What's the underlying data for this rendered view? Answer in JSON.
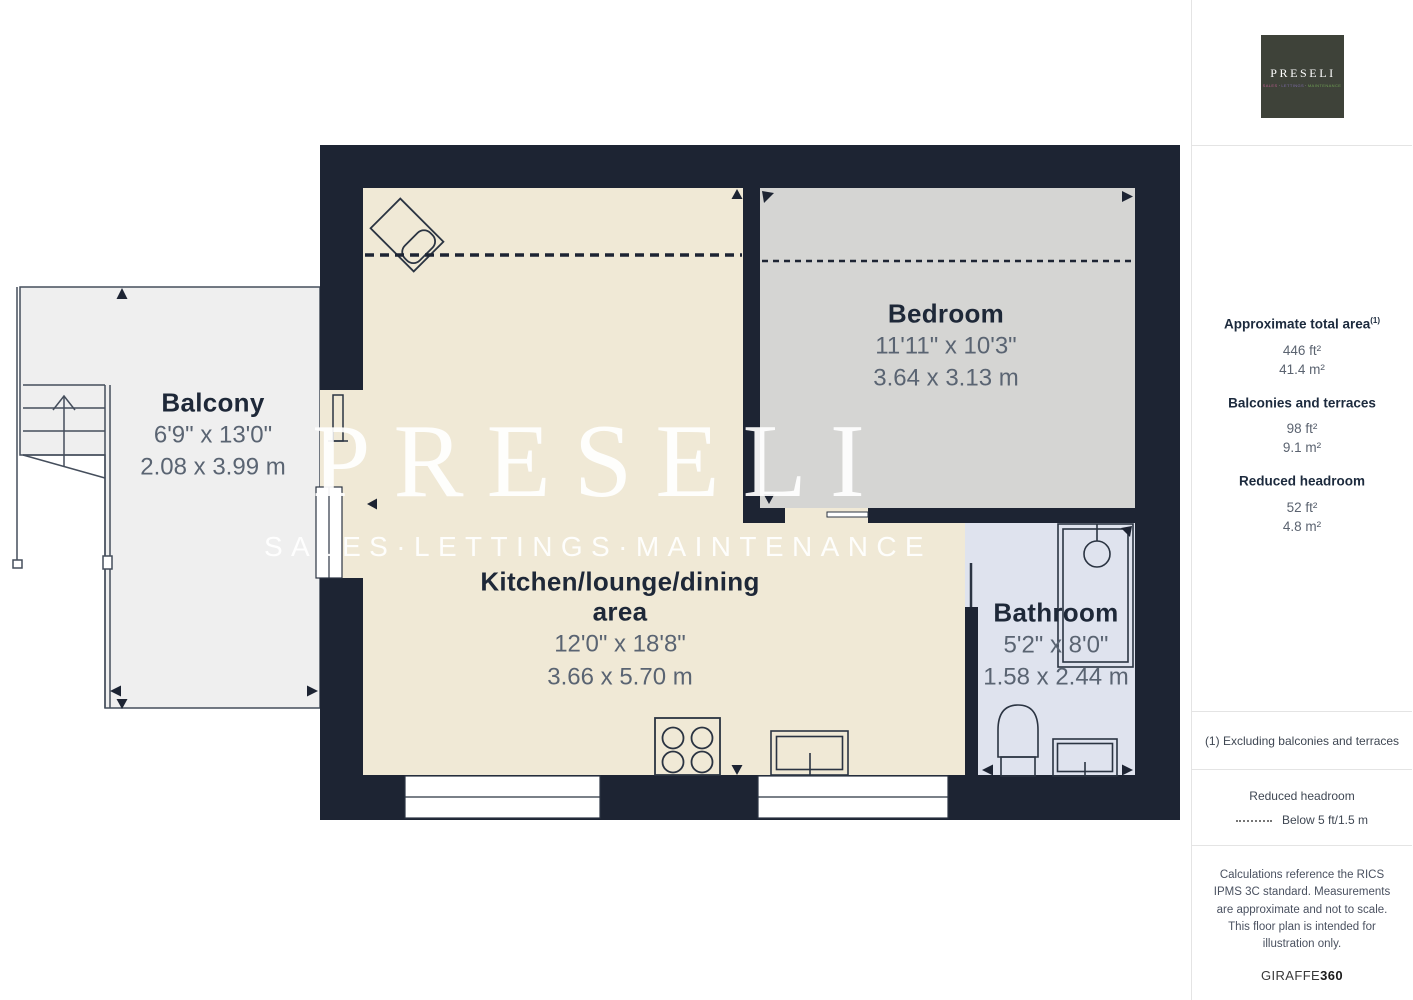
{
  "plan": {
    "watermark": {
      "title": "PRESELI",
      "subtitle": "SALES·LETTINGS·MAINTENANCE"
    },
    "rooms": [
      {
        "name": "Balcony",
        "dim_ft": "6'9\" x 13'0\"",
        "dim_m": "2.08 x 3.99 m"
      },
      {
        "name": "Bedroom",
        "dim_ft": "11'11\" x 10'3\"",
        "dim_m": "3.64 x 3.13 m"
      },
      {
        "name": "Kitchen/lounge/dining area",
        "dim_ft": "12'0\" x 18'8\"",
        "dim_m": "3.66 x 5.70 m"
      },
      {
        "name": "Bathroom",
        "dim_ft": "5'2\" x 8'0\"",
        "dim_m": "1.58 x 2.44 m"
      }
    ],
    "colors": {
      "wall": "#1d2433",
      "kitchen_fill": "#f0e9d6",
      "bedroom_fill": "#d5d5d3",
      "bathroom_fill": "#dfe3ee",
      "balcony_fill": "#efefef",
      "room_name_text": "#1e2838",
      "dimension_text": "#5a6472"
    }
  },
  "logo": {
    "name": "PRESELI",
    "separator": "·",
    "tagline": [
      "SALES",
      "LETTINGS",
      "MAINTENANCE"
    ],
    "colors": {
      "background": "#3e4239",
      "sales": "#b85c8d",
      "lettings": "#7f6cab",
      "maintenance": "#6f9e53"
    }
  },
  "sidebar": {
    "stats": [
      {
        "label": "Approximate total area",
        "sup": "(1)",
        "values": [
          "446 ft²",
          "41.4 m²"
        ]
      },
      {
        "label": "Balconies and terraces",
        "sup": "",
        "values": [
          "98 ft²",
          "9.1 m²"
        ]
      },
      {
        "label": "Reduced headroom",
        "sup": "",
        "values": [
          "52 ft²",
          "4.8 m²"
        ]
      }
    ],
    "footnote": "(1) Excluding balconies and terraces",
    "legend": {
      "title": "Reduced headroom",
      "label": "Below 5 ft/1.5 m"
    },
    "credits": "Calculations reference the RICS IPMS 3C standard. Measurements are approximate and not to scale. This floor plan is intended for illustration only.",
    "brand": {
      "name": "GIRAFFE",
      "suffix": "360"
    }
  }
}
